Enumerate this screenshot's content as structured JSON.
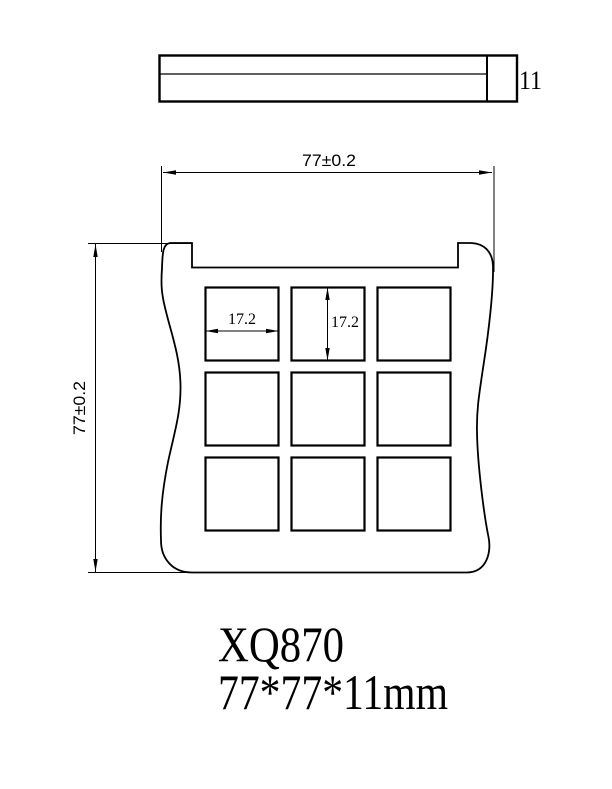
{
  "drawing": {
    "colors": {
      "line": "#000000",
      "background": "#ffffff"
    },
    "title": {
      "part_number": "XQ870",
      "size_text": "77*77*11mm"
    },
    "views": {
      "side": {
        "name": "side-elevation",
        "thickness_label": "11"
      },
      "front": {
        "name": "plan-view",
        "width_label": "77±0.2",
        "height_label": "77±0.2",
        "pan_width_label": "17.2",
        "pan_height_label": "17.2",
        "pan_grid": {
          "rows": 3,
          "columns": 3
        }
      }
    }
  }
}
